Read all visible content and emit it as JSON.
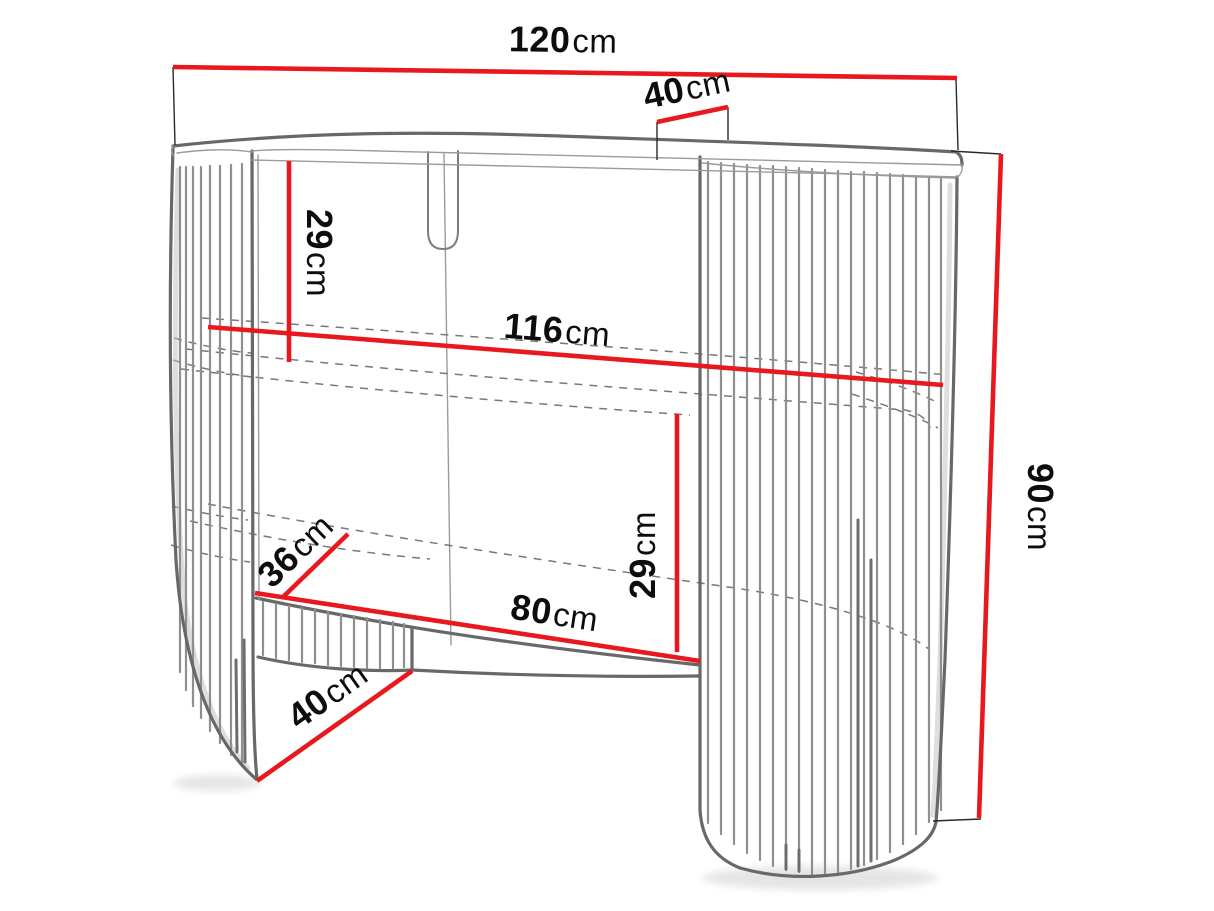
{
  "diagram": {
    "kind": "furniture-dimension-diagram",
    "unit": "cm",
    "colors": {
      "dimension_line": "#e8191e",
      "outline": "#686868",
      "label_text": "#0d0d0d",
      "background": "#ffffff"
    }
  },
  "dimensions": {
    "top_width": {
      "value": "120",
      "unit": "cm"
    },
    "top_depth": {
      "value": "40",
      "unit": "cm"
    },
    "top_to_shelf": {
      "value": "29",
      "unit": "cm"
    },
    "shelf_width": {
      "value": "116",
      "unit": "cm"
    },
    "total_height": {
      "value": "90",
      "unit": "cm"
    },
    "base_depth": {
      "value": "36",
      "unit": "cm"
    },
    "shelf_to_base": {
      "value": "29",
      "unit": "cm"
    },
    "opening_width": {
      "value": "80",
      "unit": "cm"
    },
    "pedestal_depth": {
      "value": "40",
      "unit": "cm"
    }
  }
}
